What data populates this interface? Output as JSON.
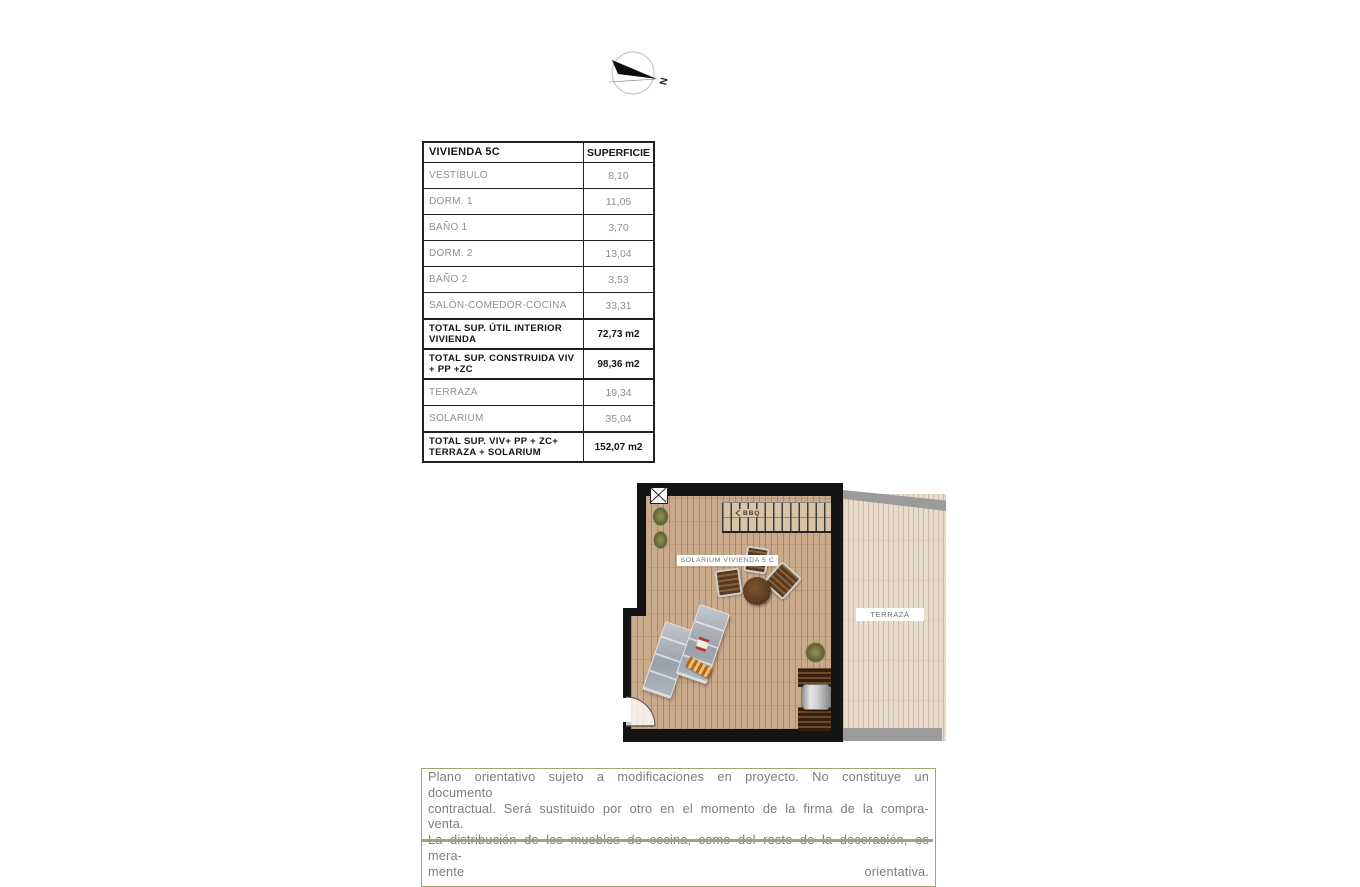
{
  "compass": {
    "north_label": "N"
  },
  "area_table": {
    "header": {
      "name": "VIVIENDA 5C",
      "area": "SUPERFICIE"
    },
    "rows": [
      {
        "label": "VESTÍBULO",
        "value": "8,10",
        "bold": false
      },
      {
        "label": "DORM. 1",
        "value": "11,05",
        "bold": false
      },
      {
        "label": "BAÑO 1",
        "value": "3,70",
        "bold": false
      },
      {
        "label": "DORM. 2",
        "value": "13,04",
        "bold": false
      },
      {
        "label": "BAÑO 2",
        "value": "3,53",
        "bold": false
      },
      {
        "label": "SALÓN-COMEDOR-COCINA",
        "value": "33,31",
        "bold": false
      },
      {
        "label": "TOTAL SUP. ÚTIL INTERIOR VIVIENDA",
        "value": "72,73 m2",
        "bold": true
      },
      {
        "label": "TOTAL SUP. CONSTRUIDA VIV + PP +ZC",
        "value": "98,36 m2",
        "bold": true
      },
      {
        "label": "TERRAZA",
        "value": "19,34",
        "bold": false
      },
      {
        "label": "SOLARIUM",
        "value": "35,04",
        "bold": false
      },
      {
        "label": "TOTAL SUP. VIV+ PP + ZC+ TERRAZA + SOLARIUM",
        "value": "152,07 m2",
        "bold": true
      }
    ]
  },
  "floor_plan": {
    "solarium_label": "SOLARIUM VIVIENDA 5 C",
    "terraza_label": "TERRAZA",
    "stairs_label": "BBQ",
    "colors": {
      "wall": "#141414",
      "solarium_floor": "#c9ab8b",
      "terraza_floor": "#e8dccd",
      "terraza_band": "#9b9b9b",
      "accent": "#a7a178"
    }
  },
  "disclaimer": {
    "lines": [
      "Plano orientativo sujeto a modificaciones en proyecto. No constituye un documento",
      "contractual. Será sustituido por otro en el momento de la firma de la compra-venta.",
      "La distribución de los muebles de cocina, como del resto de la decoración, es mera-",
      "mente orientativa."
    ]
  }
}
